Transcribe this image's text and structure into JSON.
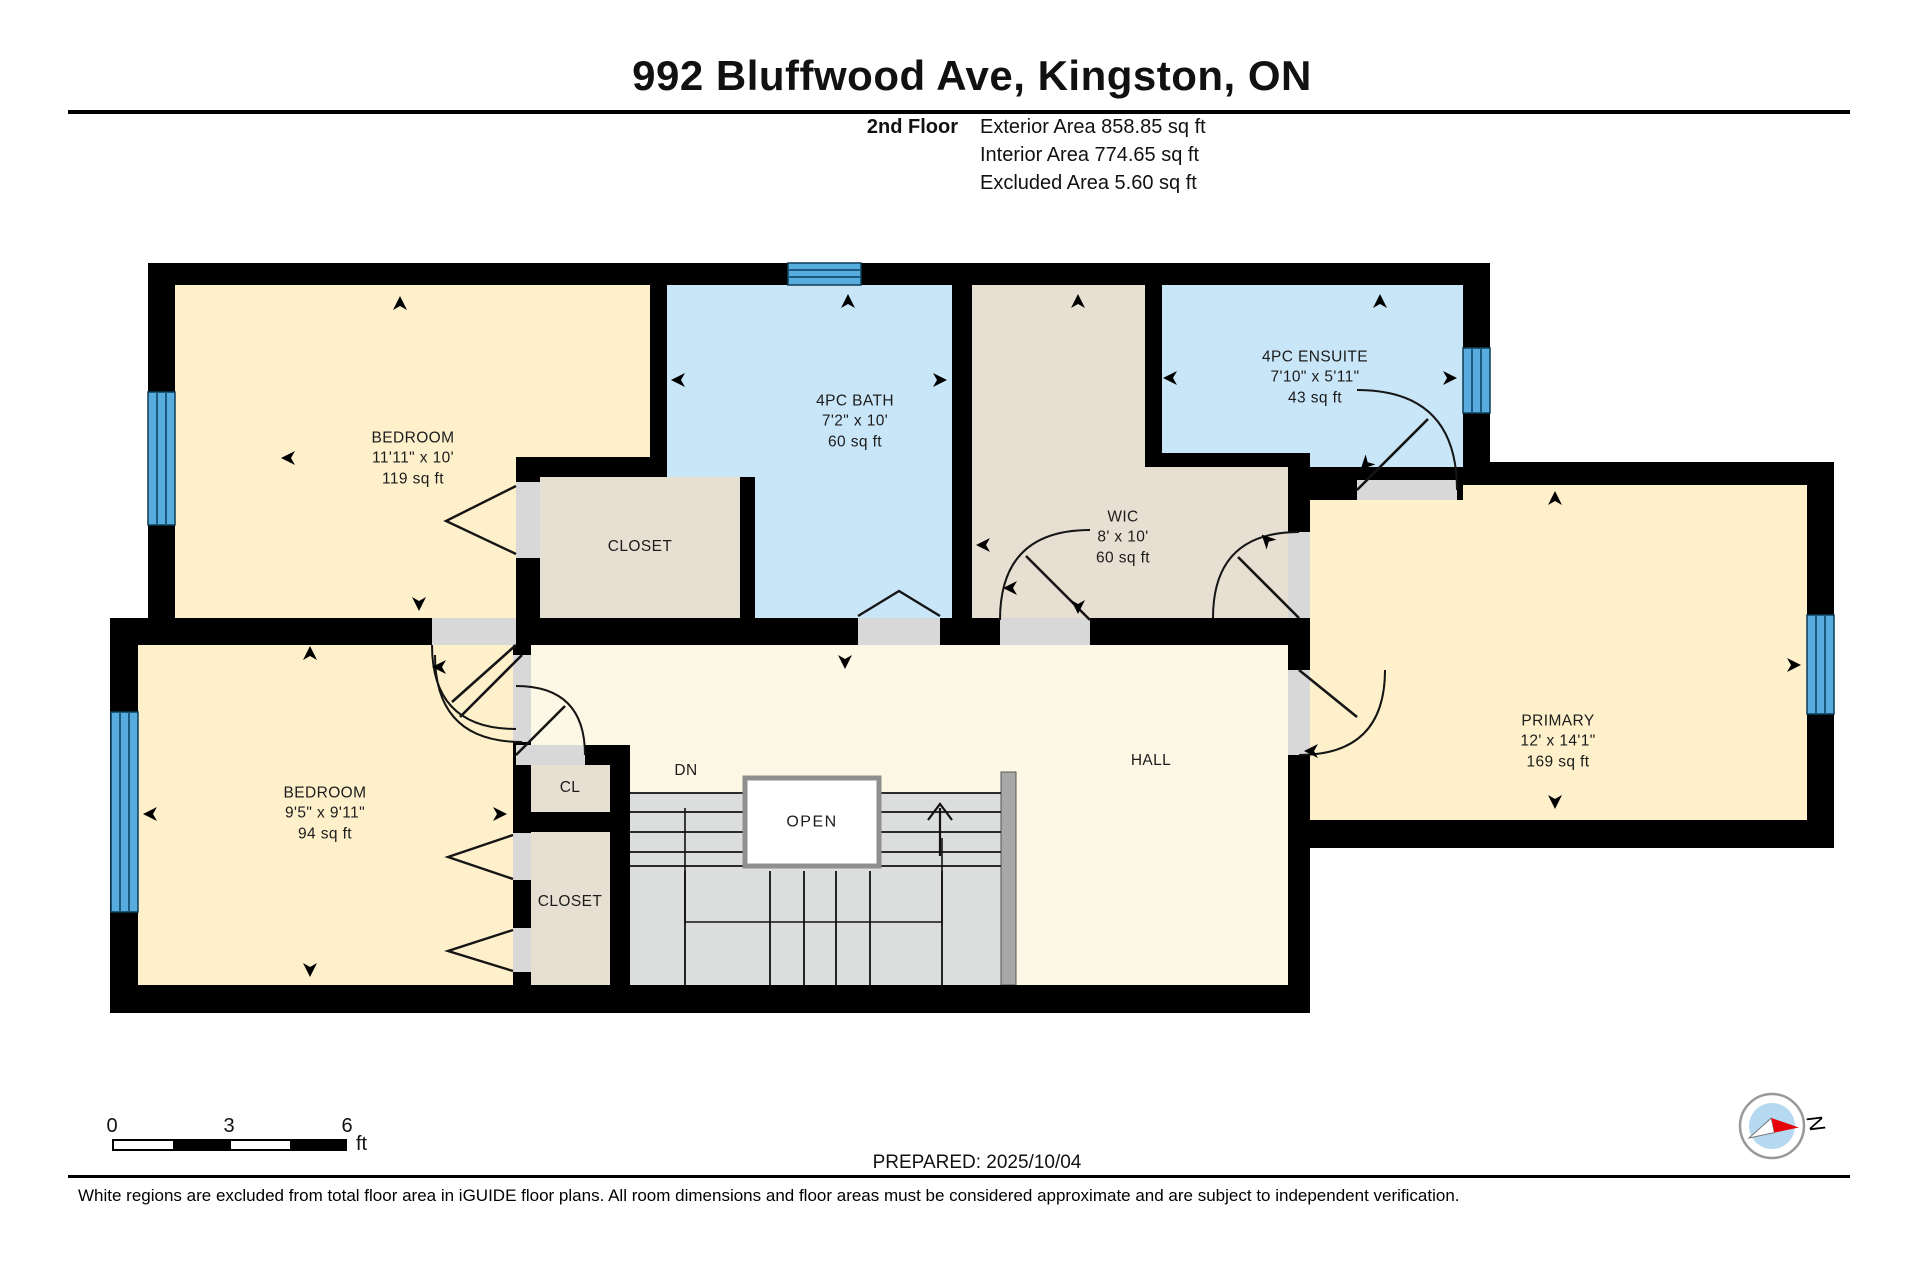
{
  "title": "992 Bluffwood Ave, Kingston, ON",
  "header": {
    "floor": "2nd Floor",
    "exterior": "Exterior Area 858.85 sq ft",
    "interior": "Interior Area 774.65 sq ft",
    "excluded": "Excluded Area 5.60 sq ft"
  },
  "rooms": {
    "bedroom1": {
      "name": "BEDROOM",
      "dims": "11'11\" x 10'",
      "area": "119 sq ft"
    },
    "bath": {
      "name": "4PC BATH",
      "dims": "7'2\" x 10'",
      "area": "60 sq ft"
    },
    "wic": {
      "name": "WIC",
      "dims": "8' x 10'",
      "area": "60 sq ft"
    },
    "ensuite": {
      "name": "4PC ENSUITE",
      "dims": "7'10\" x 5'11\"",
      "area": "43 sq ft"
    },
    "primary": {
      "name": "PRIMARY",
      "dims": "12' x 14'1\"",
      "area": "169 sq ft"
    },
    "bedroom2": {
      "name": "BEDROOM",
      "dims": "9'5\" x 9'11\"",
      "area": "94 sq ft"
    },
    "closet_upper": {
      "name": "CLOSET"
    },
    "cl": {
      "name": "CL"
    },
    "closet_lower": {
      "name": "CLOSET"
    },
    "hall": {
      "name": "HALL"
    },
    "stair_open": {
      "name": "OPEN"
    },
    "stair_dn": {
      "name": "DN"
    }
  },
  "scale_bar": {
    "start": "0",
    "mid": "3",
    "end": "6",
    "unit": "ft"
  },
  "prepared": "PREPARED: 2025/10/04",
  "compass": {
    "north": "N"
  },
  "disclaimer": "White regions are excluded from total floor area in iGUIDE floor plans. All room dimensions and floor areas must be considered approximate and are subject to independent verification.",
  "colors": {
    "room_yellow": "#fdf0cb",
    "hall_cream": "#fdf7e6",
    "bath_blue": "#c9e6f8",
    "closet_tan": "#e7dfd2",
    "window_blue": "#58abdd",
    "wall_black": "#000000",
    "door_gap_gray": "#d8d8d8",
    "stair_gray": "#dcdddd",
    "compass_red": "#e8000a"
  }
}
